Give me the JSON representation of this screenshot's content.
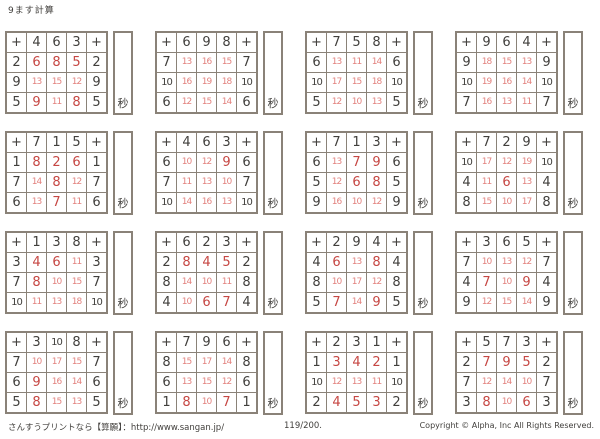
{
  "page_title": "9ます計算",
  "plus_symbol": "+",
  "seconds_label": "秒",
  "footer": {
    "left": "さんすうプリントなら【算願】：http://www.sangan.jp/",
    "center": "119/200.",
    "right": "Copyright © Alpha, Inc All Rights Reserved."
  },
  "colors": {
    "grid_line": "#8a8278",
    "black_digit": "#413f3c",
    "answer_red": "#c64743",
    "answer_red_light": "#e2817d"
  },
  "grids": [
    {
      "col_headers": [
        "4",
        "6",
        "3"
      ],
      "rows": [
        {
          "header": "2",
          "answers": [
            "6",
            "8",
            "5"
          ]
        },
        {
          "header": "9",
          "answers": [
            "13",
            "15",
            "12"
          ]
        },
        {
          "header": "5",
          "answers": [
            "9",
            "11",
            "8"
          ]
        }
      ]
    },
    {
      "col_headers": [
        "6",
        "9",
        "8"
      ],
      "rows": [
        {
          "header": "7",
          "answers": [
            "13",
            "16",
            "15"
          ]
        },
        {
          "header": "10",
          "answers": [
            "16",
            "19",
            "18"
          ]
        },
        {
          "header": "6",
          "answers": [
            "12",
            "15",
            "14"
          ]
        }
      ]
    },
    {
      "col_headers": [
        "7",
        "5",
        "8"
      ],
      "rows": [
        {
          "header": "6",
          "answers": [
            "13",
            "11",
            "14"
          ]
        },
        {
          "header": "10",
          "answers": [
            "17",
            "15",
            "18"
          ]
        },
        {
          "header": "5",
          "answers": [
            "12",
            "10",
            "13"
          ]
        }
      ]
    },
    {
      "col_headers": [
        "9",
        "6",
        "4"
      ],
      "rows": [
        {
          "header": "9",
          "answers": [
            "18",
            "15",
            "13"
          ]
        },
        {
          "header": "10",
          "answers": [
            "19",
            "16",
            "14"
          ]
        },
        {
          "header": "7",
          "answers": [
            "16",
            "13",
            "11"
          ]
        }
      ]
    },
    {
      "col_headers": [
        "7",
        "1",
        "5"
      ],
      "rows": [
        {
          "header": "1",
          "answers": [
            "8",
            "2",
            "6"
          ]
        },
        {
          "header": "7",
          "answers": [
            "14",
            "8",
            "12"
          ]
        },
        {
          "header": "6",
          "answers": [
            "13",
            "7",
            "11"
          ]
        }
      ]
    },
    {
      "col_headers": [
        "4",
        "6",
        "3"
      ],
      "rows": [
        {
          "header": "6",
          "answers": [
            "10",
            "12",
            "9"
          ]
        },
        {
          "header": "7",
          "answers": [
            "11",
            "13",
            "10"
          ]
        },
        {
          "header": "10",
          "answers": [
            "14",
            "16",
            "13"
          ]
        }
      ]
    },
    {
      "col_headers": [
        "7",
        "1",
        "3"
      ],
      "rows": [
        {
          "header": "6",
          "answers": [
            "13",
            "7",
            "9"
          ]
        },
        {
          "header": "5",
          "answers": [
            "12",
            "6",
            "8"
          ]
        },
        {
          "header": "9",
          "answers": [
            "16",
            "10",
            "12"
          ]
        }
      ]
    },
    {
      "col_headers": [
        "7",
        "2",
        "9"
      ],
      "rows": [
        {
          "header": "10",
          "answers": [
            "17",
            "12",
            "19"
          ]
        },
        {
          "header": "4",
          "answers": [
            "11",
            "6",
            "13"
          ]
        },
        {
          "header": "8",
          "answers": [
            "15",
            "10",
            "17"
          ]
        }
      ]
    },
    {
      "col_headers": [
        "1",
        "3",
        "8"
      ],
      "rows": [
        {
          "header": "3",
          "answers": [
            "4",
            "6",
            "11"
          ]
        },
        {
          "header": "7",
          "answers": [
            "8",
            "10",
            "15"
          ]
        },
        {
          "header": "10",
          "answers": [
            "11",
            "13",
            "18"
          ]
        }
      ]
    },
    {
      "col_headers": [
        "6",
        "2",
        "3"
      ],
      "rows": [
        {
          "header": "2",
          "answers": [
            "8",
            "4",
            "5"
          ]
        },
        {
          "header": "8",
          "answers": [
            "14",
            "10",
            "11"
          ]
        },
        {
          "header": "4",
          "answers": [
            "10",
            "6",
            "7"
          ]
        }
      ]
    },
    {
      "col_headers": [
        "2",
        "9",
        "4"
      ],
      "rows": [
        {
          "header": "4",
          "answers": [
            "6",
            "13",
            "8"
          ]
        },
        {
          "header": "8",
          "answers": [
            "10",
            "17",
            "12"
          ]
        },
        {
          "header": "5",
          "answers": [
            "7",
            "14",
            "9"
          ]
        }
      ]
    },
    {
      "col_headers": [
        "3",
        "6",
        "5"
      ],
      "rows": [
        {
          "header": "7",
          "answers": [
            "10",
            "13",
            "12"
          ]
        },
        {
          "header": "4",
          "answers": [
            "7",
            "10",
            "9"
          ]
        },
        {
          "header": "9",
          "answers": [
            "12",
            "15",
            "14"
          ]
        }
      ]
    },
    {
      "col_headers": [
        "3",
        "10",
        "8"
      ],
      "rows": [
        {
          "header": "7",
          "answers": [
            "10",
            "17",
            "15"
          ]
        },
        {
          "header": "6",
          "answers": [
            "9",
            "16",
            "14"
          ]
        },
        {
          "header": "5",
          "answers": [
            "8",
            "15",
            "13"
          ]
        }
      ]
    },
    {
      "col_headers": [
        "7",
        "9",
        "6"
      ],
      "rows": [
        {
          "header": "8",
          "answers": [
            "15",
            "17",
            "14"
          ]
        },
        {
          "header": "6",
          "answers": [
            "13",
            "15",
            "12"
          ]
        },
        {
          "header": "1",
          "answers": [
            "8",
            "10",
            "7"
          ]
        }
      ]
    },
    {
      "col_headers": [
        "2",
        "3",
        "1"
      ],
      "rows": [
        {
          "header": "1",
          "answers": [
            "3",
            "4",
            "2"
          ]
        },
        {
          "header": "10",
          "answers": [
            "12",
            "13",
            "11"
          ]
        },
        {
          "header": "2",
          "answers": [
            "4",
            "5",
            "3"
          ]
        }
      ]
    },
    {
      "col_headers": [
        "5",
        "7",
        "3"
      ],
      "rows": [
        {
          "header": "2",
          "answers": [
            "7",
            "9",
            "5"
          ]
        },
        {
          "header": "7",
          "answers": [
            "12",
            "14",
            "10"
          ]
        },
        {
          "header": "3",
          "answers": [
            "8",
            "10",
            "6"
          ]
        }
      ]
    }
  ]
}
